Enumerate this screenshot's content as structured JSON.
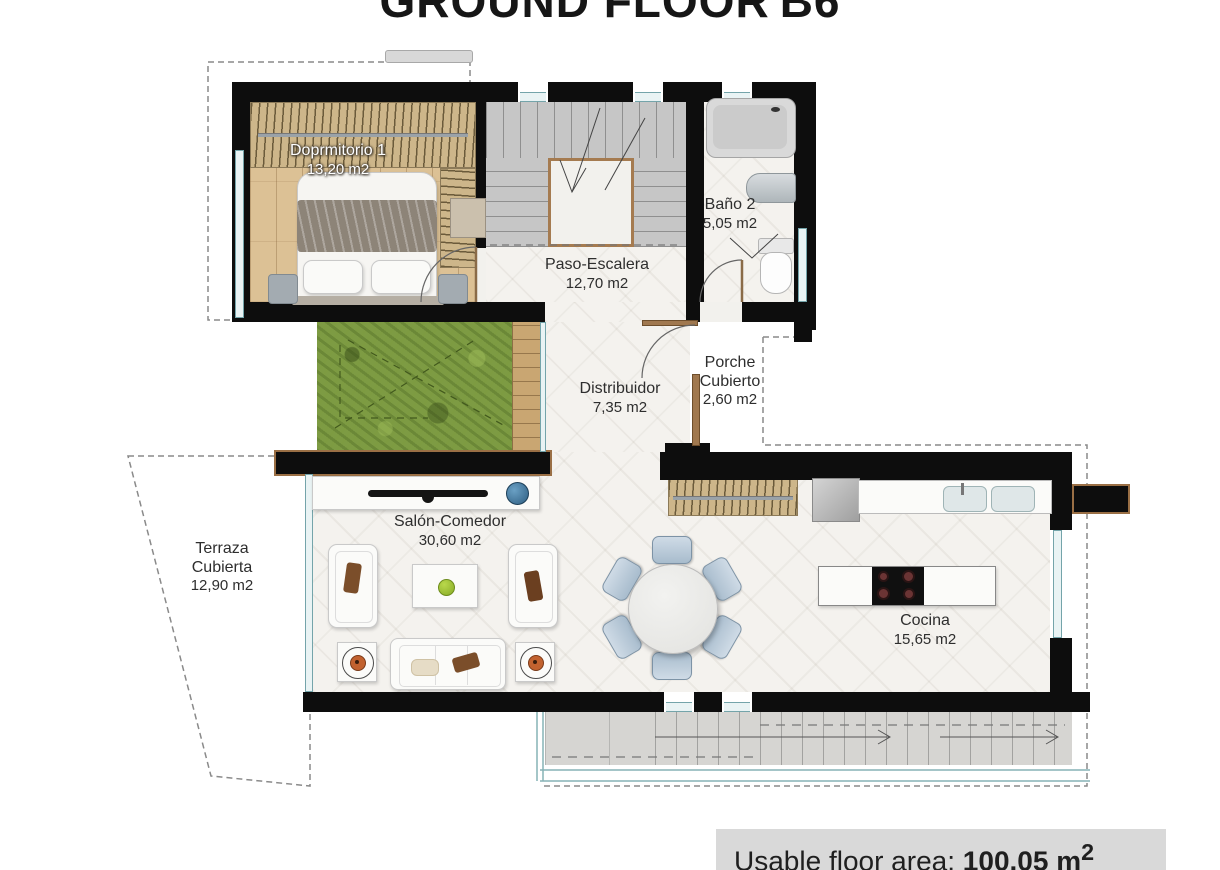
{
  "title": {
    "text": "GROUND FLOOR",
    "unit": "B6"
  },
  "rooms": {
    "dormitorio": {
      "name": "Doprmitorio 1",
      "area": "13,20 m2"
    },
    "paso": {
      "name": "Paso-Escalera",
      "area": "12,70 m2"
    },
    "bano": {
      "name": "Baño 2",
      "area": "5,05 m2"
    },
    "distribuidor": {
      "name": "Distribuidor",
      "area": "7,35 m2"
    },
    "porche": {
      "line1": "Porche",
      "line2": "Cubierto",
      "area": "2,60 m2"
    },
    "salon": {
      "name": "Salón-Comedor",
      "area": "30,60 m2"
    },
    "terraza": {
      "line1": "Terraza",
      "line2": "Cubierta",
      "area": "12,90 m2"
    },
    "cocina": {
      "name": "Cocina",
      "area": "15,65 m2"
    }
  },
  "footer": {
    "label": "Usable floor area: ",
    "value": "100.05 m",
    "sup": "2"
  },
  "colors": {
    "wall": "#0d0d0d",
    "wood_floor": "#dcc195",
    "grass": "#7d9b43",
    "glass": "#e9f3f4",
    "deck": "#d6d5d2",
    "accent_orange": "#c2622f",
    "footer_bg": "#d9d9d9"
  }
}
